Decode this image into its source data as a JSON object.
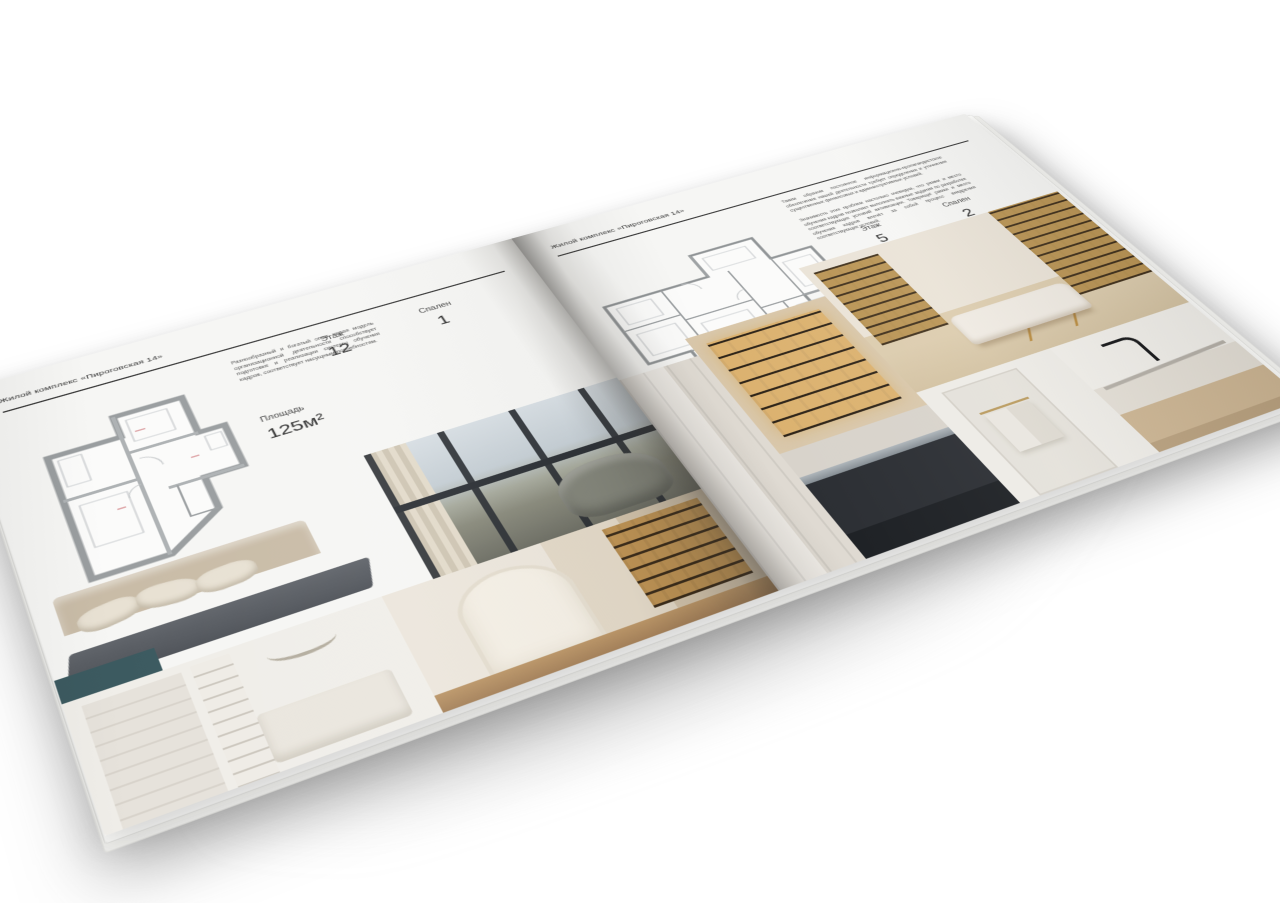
{
  "brochure": {
    "page_color": "#f6f6f4",
    "rule_color": "#3a3a3a",
    "accent_wood": "#caa35c",
    "left_page": {
      "header": "Жилой комплекс «Пироговская 14»",
      "intro": "Разнообразный и богатый опыт новая модель организационной деятельности способствует подготовке и реализации системы обучения кадров, соответствует насущным потребностям.",
      "stats": {
        "area_label": "Площадь",
        "area_value": "125м²",
        "floor_label": "Этаж",
        "floor_value": "12",
        "bedrooms_label": "Спален",
        "bedrooms_value": "1"
      },
      "floor_plan": "apartment-plan-125",
      "photos": [
        {
          "name": "bedroom",
          "description": "спальня с мягким изголовьем и подушками"
        },
        {
          "name": "living-room-window",
          "description": "гостиная с панорамным окном и креслом"
        },
        {
          "name": "white-bedroom",
          "description": "белая спальня со шкафом и полками"
        },
        {
          "name": "library-hall",
          "description": "холл с аркой и книжными стеллажами"
        }
      ]
    },
    "right_page": {
      "header": "Жилой комплекс «Пироговская 14»",
      "intro_1": "Таким образом постоянное информационно-пропагандистское обеспечение нашей деятельности требует определения и уточнения существенных финансовых и административных условий.",
      "intro_2": "Значимость этих проблем настолько очевидна, что рамки и место обучения кадров позволяет выполнять важные задания по разработке соответствующих условий активизации. Товарищи! рамки и место обучения кадров влечёт за собой процесс внедрения соответствующих условий.",
      "stats": {
        "area_label": "Площадь",
        "area_value": "200м²",
        "floor_label": "Этаж",
        "floor_value": "5",
        "bedrooms_label": "Спален",
        "bedrooms_value": "2"
      },
      "floor_plan": "apartment-plan-200",
      "photos": [
        {
          "name": "wardrobe-panel",
          "description": "светлые панели шкафа"
        },
        {
          "name": "kitchen-cabinet",
          "description": "кухонный шкаф-витрина с подсветкой"
        },
        {
          "name": "study-lounge",
          "description": "кабинет со стеллажами и кушеткой на золотых ножках"
        },
        {
          "name": "cooktop",
          "description": "тёмная варочная поверхность"
        },
        {
          "name": "bathroom-towel",
          "description": "ванная с полотенцем"
        },
        {
          "name": "bathroom-vanity",
          "description": "мраморная раковина с чёрным смесителем"
        }
      ]
    }
  }
}
